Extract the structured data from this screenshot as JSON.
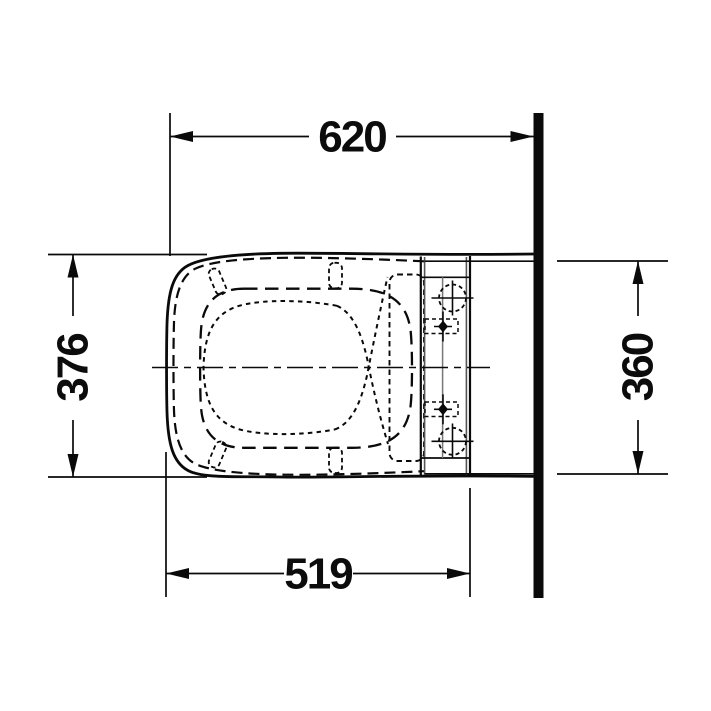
{
  "page": {
    "background_color": "#ffffff",
    "line_color": "#000000"
  },
  "drawing": {
    "type": "technical-dimension-drawing",
    "subject": "wall-hung-toilet-with-seat-top-view",
    "dimensions": {
      "overall_depth": {
        "value": "620",
        "orientation": "horizontal",
        "position": "top"
      },
      "body_width": {
        "value": "376",
        "orientation": "vertical",
        "position": "left"
      },
      "rear_width": {
        "value": "360",
        "orientation": "vertical",
        "position": "right"
      },
      "bowl_depth": {
        "value": "519",
        "orientation": "horizontal",
        "position": "bottom"
      }
    }
  }
}
